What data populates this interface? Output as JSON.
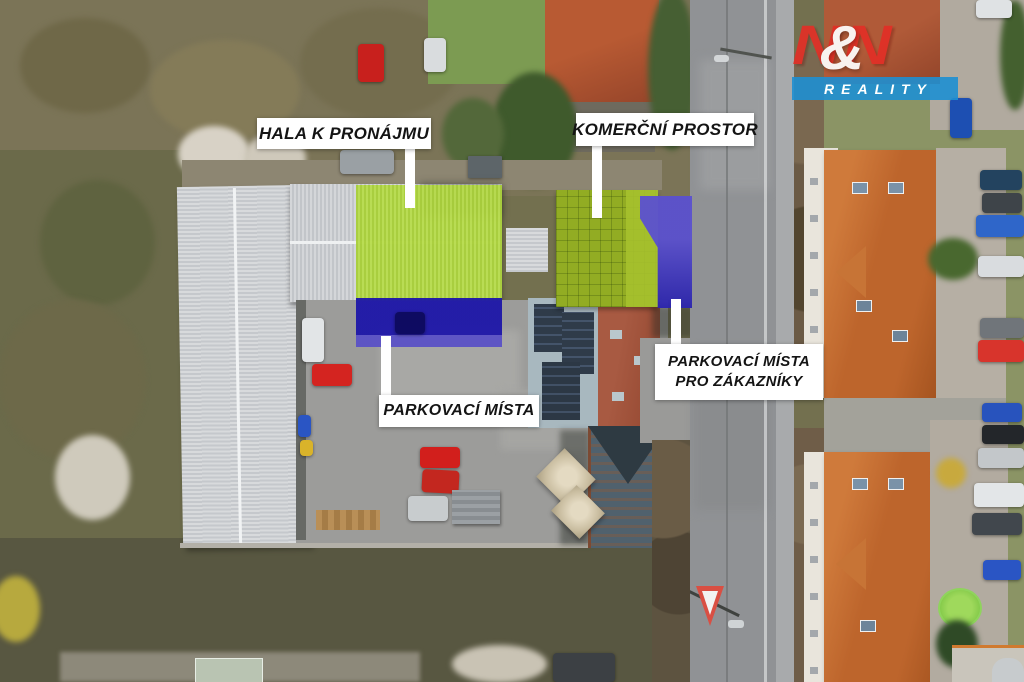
{
  "annotations": {
    "hall": {
      "label": "HALA K PRONÁJMU"
    },
    "commercial": {
      "label": "KOMERČNÍ PROSTOR"
    },
    "parking": {
      "label": "PARKOVACÍ MÍSTA"
    },
    "customer_parking": {
      "line1": "PARKOVACÍ MÍSTA",
      "line2": "PRO ZÁKAZNÍKY"
    }
  },
  "logo": {
    "letter_left": "N",
    "ampersand": "&",
    "letter_right": "N",
    "wordmark": "REALITY",
    "red": "#e22f26",
    "blue": "#1f8fd2"
  },
  "overlays": {
    "hall_roof_highlight": "#b2d645",
    "commercial_roof_highlight": "#96b126",
    "parking_highlight": "#1d16a8",
    "customer_parking_highlight": "#544bcd"
  }
}
